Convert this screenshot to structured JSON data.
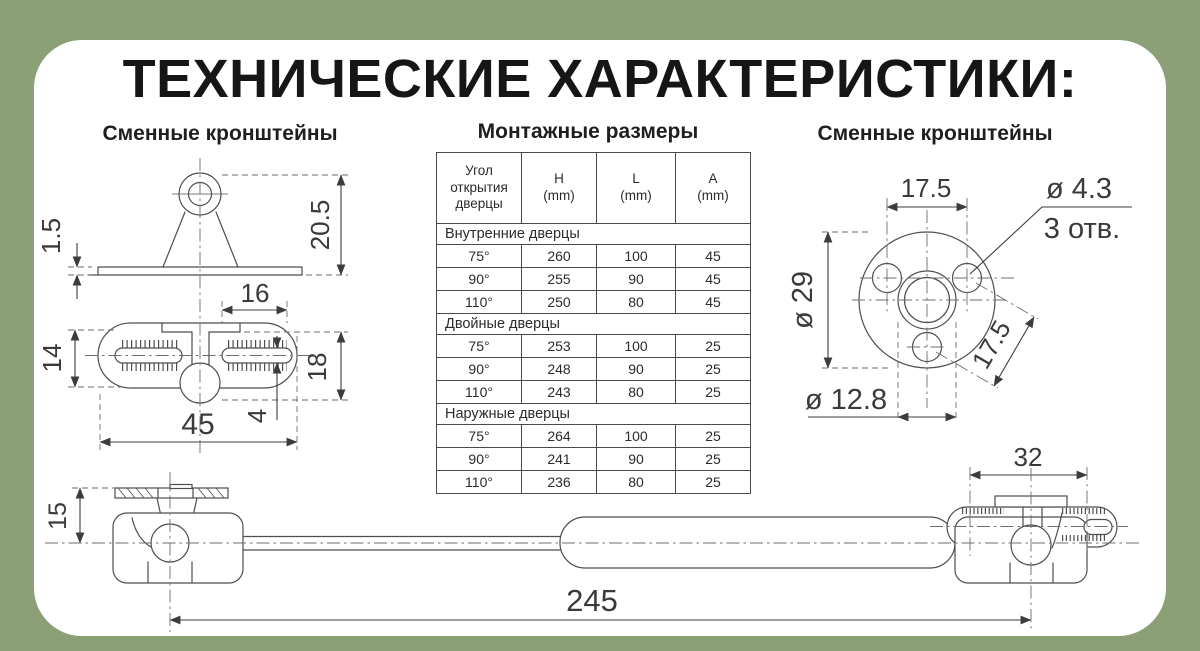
{
  "title": "ТЕХНИЧЕСКИЕ ХАРАКТЕРИСТИКИ:",
  "headings": {
    "left": "Сменные кронштейны",
    "center": "Монтажные размеры",
    "right": "Сменные кронштейны"
  },
  "table": {
    "headers": [
      "Угол открытия дверцы",
      "H\n(mm)",
      "L\n(mm)",
      "A\n(mm)"
    ],
    "sections": [
      {
        "label": "Внутренние дверцы",
        "rows": [
          [
            "75°",
            "260",
            "100",
            "45"
          ],
          [
            "90°",
            "255",
            "90",
            "45"
          ],
          [
            "110°",
            "250",
            "80",
            "45"
          ]
        ]
      },
      {
        "label": "Двойные дверцы",
        "rows": [
          [
            "75°",
            "253",
            "100",
            "25"
          ],
          [
            "90°",
            "248",
            "90",
            "25"
          ],
          [
            "110°",
            "243",
            "80",
            "25"
          ]
        ]
      },
      {
        "label": "Наружные дверцы",
        "rows": [
          [
            "75°",
            "264",
            "100",
            "25"
          ],
          [
            "90°",
            "241",
            "90",
            "25"
          ],
          [
            "110°",
            "236",
            "80",
            "25"
          ]
        ]
      }
    ]
  },
  "drawings": {
    "top_bracket": {
      "dim_height": "20.5",
      "dim_thickness": "1.5",
      "dim_hole_offset": "16"
    },
    "oval_bracket": {
      "dim_width": "14",
      "dim_height": "18",
      "dim_slot": "4",
      "dim_length": "45"
    },
    "flange": {
      "dim_top_spacing": "17.5",
      "dim_hole_dia": "ø 4.3",
      "dim_hole_count": "3 отв.",
      "dim_outer_dia": "ø 29",
      "dim_diag_spacing": "17.5",
      "dim_center_dia": "ø 12.8"
    },
    "gas_lift": {
      "dim_height": "15",
      "dim_bracket_width": "32",
      "dim_length": "245"
    }
  },
  "colors": {
    "background": "#8BA077",
    "card": "#FFFFFF",
    "line": "#4E4E4E",
    "text": "#222222"
  }
}
